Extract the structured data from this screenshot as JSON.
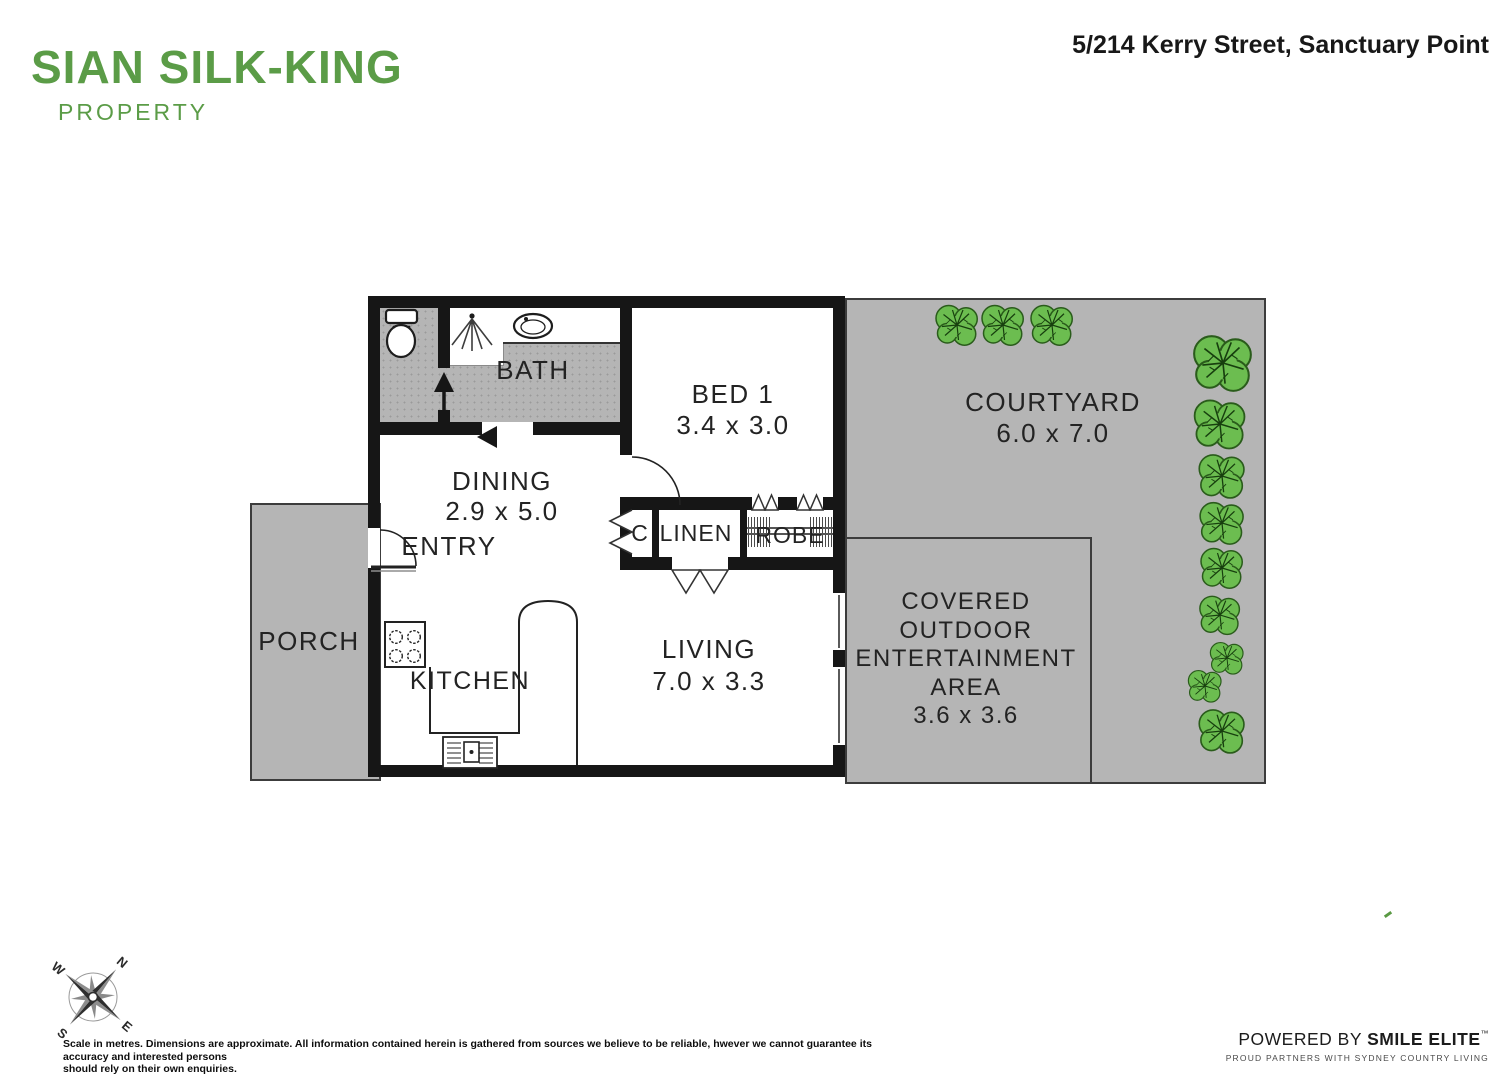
{
  "header": {
    "logo_line1": "SIAN SILK-KING",
    "logo_line2": "PROPERTY",
    "address": "5/214 Kerry Street, Sanctuary Point"
  },
  "plan": {
    "rooms": {
      "bath": {
        "name": "BATH"
      },
      "bed1": {
        "name": "BED 1",
        "dims": "3.4 x 3.0"
      },
      "courtyard": {
        "name": "COURTYARD",
        "dims": "6.0 x 7.0"
      },
      "dining": {
        "name": "DINING",
        "dims": "2.9 x 5.0"
      },
      "entry": {
        "name": "ENTRY"
      },
      "closet": {
        "name": "C"
      },
      "linen": {
        "name": "LINEN"
      },
      "robe": {
        "name": "ROBE"
      },
      "porch": {
        "name": "PORCH"
      },
      "kitchen": {
        "name": "KITCHEN"
      },
      "living": {
        "name": "LIVING",
        "dims": "7.0 x 3.3"
      },
      "outdoor": {
        "line1": "COVERED",
        "line2": "OUTDOOR",
        "line3": "ENTERTAINMENT",
        "line4": "AREA",
        "dims": "3.6 x 3.6"
      }
    }
  },
  "compass": {
    "n": "N",
    "e": "E",
    "s": "S",
    "w": "W"
  },
  "footer": {
    "disclaimer_line1": "Scale in metres. Dimensions are approximate. All information contained herein is gathered from sources we believe to be reliable, hwever we cannot guarantee its accuracy and interested persons",
    "disclaimer_line2": "should rely on their own enquiries.",
    "powered_prefix": "POWERED BY ",
    "powered_brand": "SMILE ELITE",
    "powered_tm": "™",
    "partners": "PROUD PARTNERS WITH SYDNEY COUNTRY LIVING"
  },
  "icons": [
    "toilet-icon",
    "shower-icon",
    "basin-icon",
    "cooktop-icon",
    "sink-icon",
    "bush-icon",
    "compass-icon",
    "door-arc-icon",
    "direction-arrow-icon"
  ],
  "colors": {
    "brand_green": "#5b9c47",
    "area_gray": "#b5b5b5",
    "wall_black": "#161616",
    "tree_green": "#6cbd50",
    "text_dark": "#232323"
  }
}
